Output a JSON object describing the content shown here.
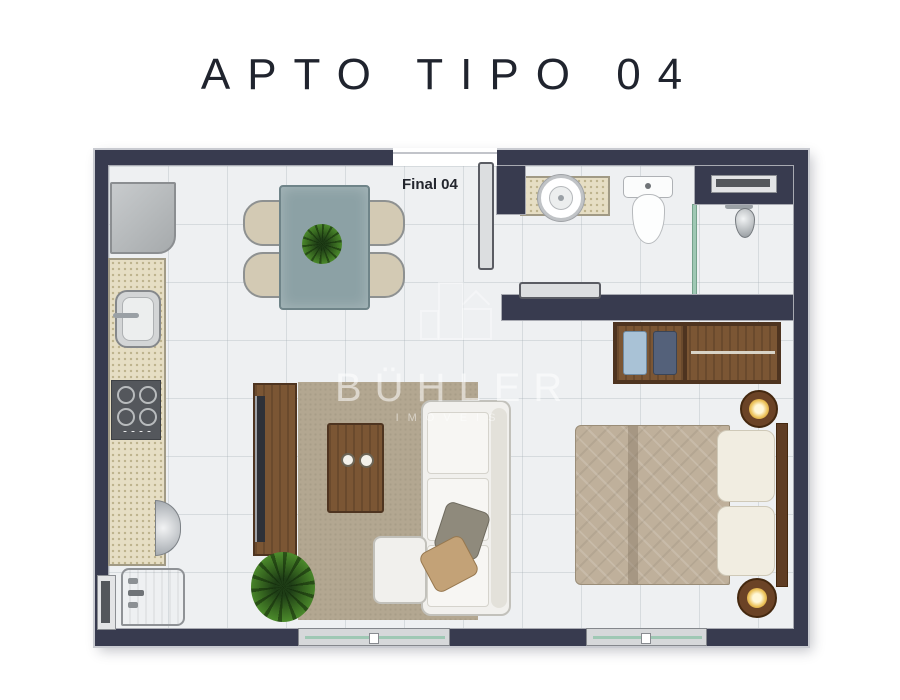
{
  "page": {
    "title": "APTO TIPO 04"
  },
  "plan": {
    "unit_label": "Final 04",
    "watermark": {
      "brand": "BÜHLER",
      "tagline": "IMÓVEIS",
      "logo": "building-outline-icon"
    },
    "colors": {
      "wall": "#383b4f",
      "floor": "#eef0f2",
      "counter_granite": "#e6dec4",
      "wood": "#7b5634",
      "rug": "#b3a791",
      "dining_table": "#8ca1a5",
      "sofa": "#f1f0ed",
      "bed_quilt": "#bfb09b",
      "glass": "#9fc8b4",
      "lamp_glow": "#ecc35c",
      "plant": "#35641f"
    },
    "rooms": {
      "kitchen": {
        "items": [
          "refrigerator",
          "granite-counter",
          "kitchen-sink",
          "cooktop",
          "counter-faucet",
          "laundry-tank",
          "service-window"
        ]
      },
      "dining": {
        "items": [
          "dining-table",
          "chair-x4",
          "plant-centerpiece"
        ]
      },
      "living": {
        "items": [
          "tv-panel",
          "tv-screen",
          "rug",
          "coffee-table",
          "cups-x2",
          "l-shaped-sofa",
          "chaise",
          "throw-pillow-x2",
          "floor-plant",
          "balcony-sliding-door"
        ]
      },
      "bedroom": {
        "items": [
          "open-wardrobe",
          "folded-clothes",
          "hanging-clothes",
          "double-bed",
          "pillows-x2",
          "headboard",
          "nightstand-lamp-x2",
          "balcony-sliding-door"
        ]
      },
      "bathroom": {
        "items": [
          "vanity-counter",
          "round-sink",
          "toilet",
          "shower",
          "shower-head",
          "glass-partition",
          "sliding-door",
          "window"
        ]
      },
      "hall": {
        "items": [
          "entry-door",
          "unit-label"
        ]
      }
    }
  }
}
